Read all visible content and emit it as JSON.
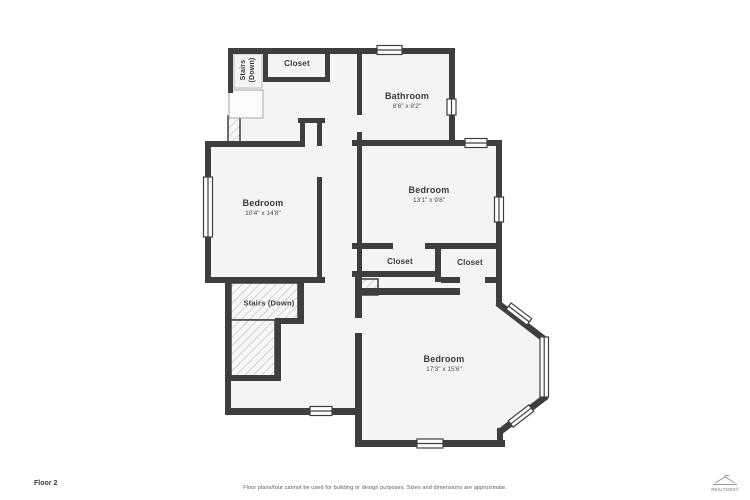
{
  "rooms": {
    "bathroom": {
      "name": "Bathroom",
      "dims": "8'6\" x 8'2\""
    },
    "bedroom_left": {
      "name": "Bedroom",
      "dims": "10'4\" x 14'8\""
    },
    "bedroom_right": {
      "name": "Bedroom",
      "dims": "13'1\" x 9'8\""
    },
    "bedroom_bottom": {
      "name": "Bedroom",
      "dims": "17'3\" x 15'6\""
    },
    "closet_top": {
      "name": "Closet"
    },
    "closet_left": {
      "name": "Closet"
    },
    "closet_right": {
      "name": "Closet"
    },
    "stairs_top": {
      "name": "Stairs (Down)"
    },
    "stairs_mid": {
      "name": "Stairs (Down)"
    }
  },
  "footer": {
    "floor_label": "Floor 2",
    "disclaimer": "Floor plans/tour cannot be used for building or design purposes. Sizes and dimensions are approximate.",
    "logo_text": "REALTORS®"
  },
  "colors": {
    "wall": "#3e3e3e",
    "room_fill": "#f4f4f4",
    "window_fill": "#ffffff",
    "hatch_line": "#c4c4c4"
  }
}
